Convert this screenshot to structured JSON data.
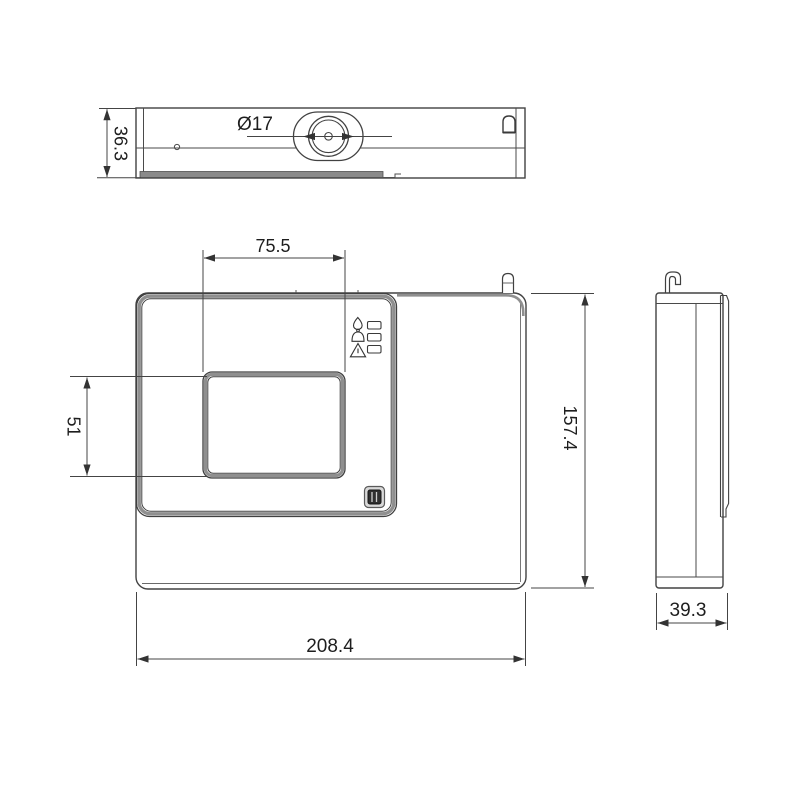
{
  "drawing": {
    "title": "device-dimension-drawing",
    "views": {
      "top_view": "top-view",
      "front_view": "front-view",
      "side_view": "side-view"
    },
    "dimensions": {
      "overall_width": "208.4",
      "overall_height": "157.4",
      "depth": "39.3",
      "top_thickness": "36.3",
      "display_width": "75.5",
      "display_height": "51",
      "knob_diameter": "Ø17"
    },
    "icons": {
      "flame": "flame-icon",
      "bell": "bell-icon",
      "warning": "warning-triangle-icon",
      "leds": "led-indicator-windows",
      "lock_tab": "mounting-clip-top",
      "hook": "mounting-hook-side"
    },
    "colors": {
      "line": "#3f3f3f",
      "thick_band": "#8f8f8f",
      "bottom_bar": "#8a8a8a",
      "button_dark": "#2f2f2f",
      "text": "#1e1e1e",
      "background": "#ffffff"
    }
  }
}
